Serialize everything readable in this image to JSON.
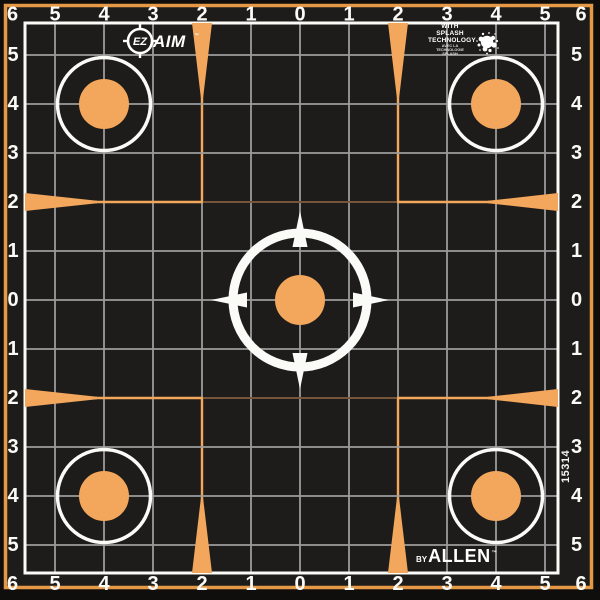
{
  "colors": {
    "edge_black": "#0F0E0D",
    "paper_black": "#1E1C1A",
    "border_orange": "#E59845",
    "orange": "#F3A75C",
    "dim_orange": "#75563C",
    "grid_gray": "#9C9C9C",
    "white": "#FAFAF7"
  },
  "axis": {
    "sequence": [
      "6",
      "5",
      "4",
      "3",
      "2",
      "1",
      "0",
      "1",
      "2",
      "3",
      "4",
      "5",
      "6"
    ]
  },
  "branding": {
    "ez": "EZ",
    "aim": "AIM",
    "tm": "™",
    "splash": {
      "line1": "WITH SPLASH",
      "line2": "TECHNOLOGY",
      "line3": "AVEC LA TECHNOLOGIE",
      "line4": "SPLASH"
    },
    "allen": {
      "by": "BY",
      "name": "ALLEN",
      "tm": "™"
    },
    "sku": "15314"
  }
}
